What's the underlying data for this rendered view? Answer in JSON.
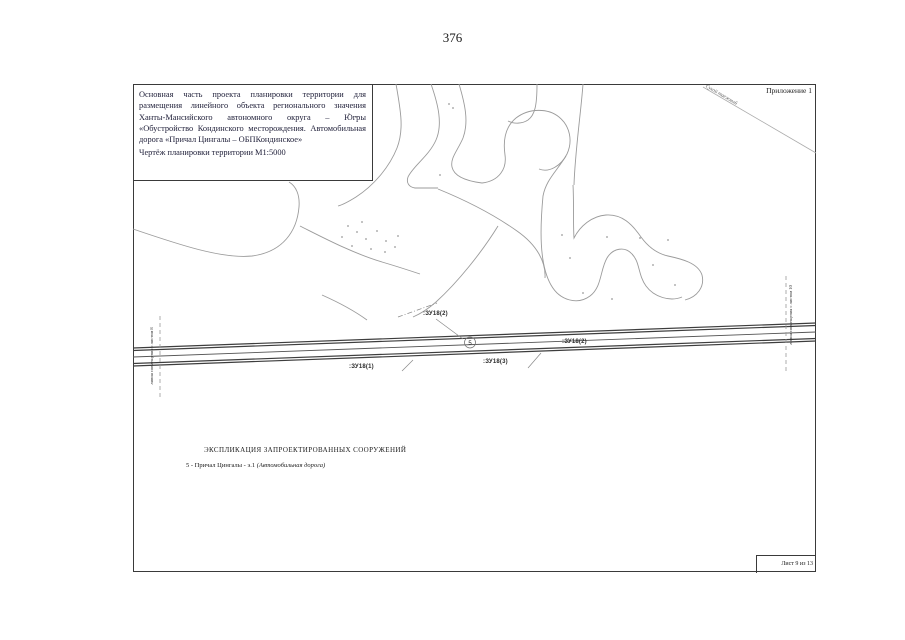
{
  "page": {
    "number": "376"
  },
  "colors": {
    "paper": "#ffffff",
    "frame": "#3a3a3a",
    "contour": "#9b9b9b",
    "road": "#3d3d3d",
    "title_text": "#1e1e38"
  },
  "title_block": {
    "paragraph": "Основная часть проекта планировки территории для размещения линейного объекта регионального значения Ханты-Мансийского автономного округа – Югры «Обустройство Кондинского месторождения. Автомобильная дорога «Причал Цингалы – ОБПКондинское»",
    "scale_line": "Чертёж планировки территории  М1:5000"
  },
  "annex_label": "Приложение 1",
  "stream_label": "Сухой таежный",
  "match_lines": {
    "left": "линия совмещения с листом 8",
    "right": "линия совмещения с листом 10"
  },
  "road": {
    "marker": "5",
    "labels": [
      {
        "text": ":ЗУ18(2)"
      },
      {
        "text": ":ЗУ18(1)"
      },
      {
        "text": ":ЗУ18(3)"
      },
      {
        "text": ":ЗУ18(2)"
      }
    ]
  },
  "legend": {
    "header": "ЭКСПЛИКАЦИЯ ЗАПРОЕКТИРОВАННЫХ СООРУЖЕНИЙ",
    "items": [
      {
        "num": "5",
        "sep": "-",
        "name": "Причал Цингалы - э.1",
        "note": "(Автомобильная дорога)"
      }
    ]
  },
  "footer": {
    "sheet_label": "Лист 9 из 13"
  }
}
